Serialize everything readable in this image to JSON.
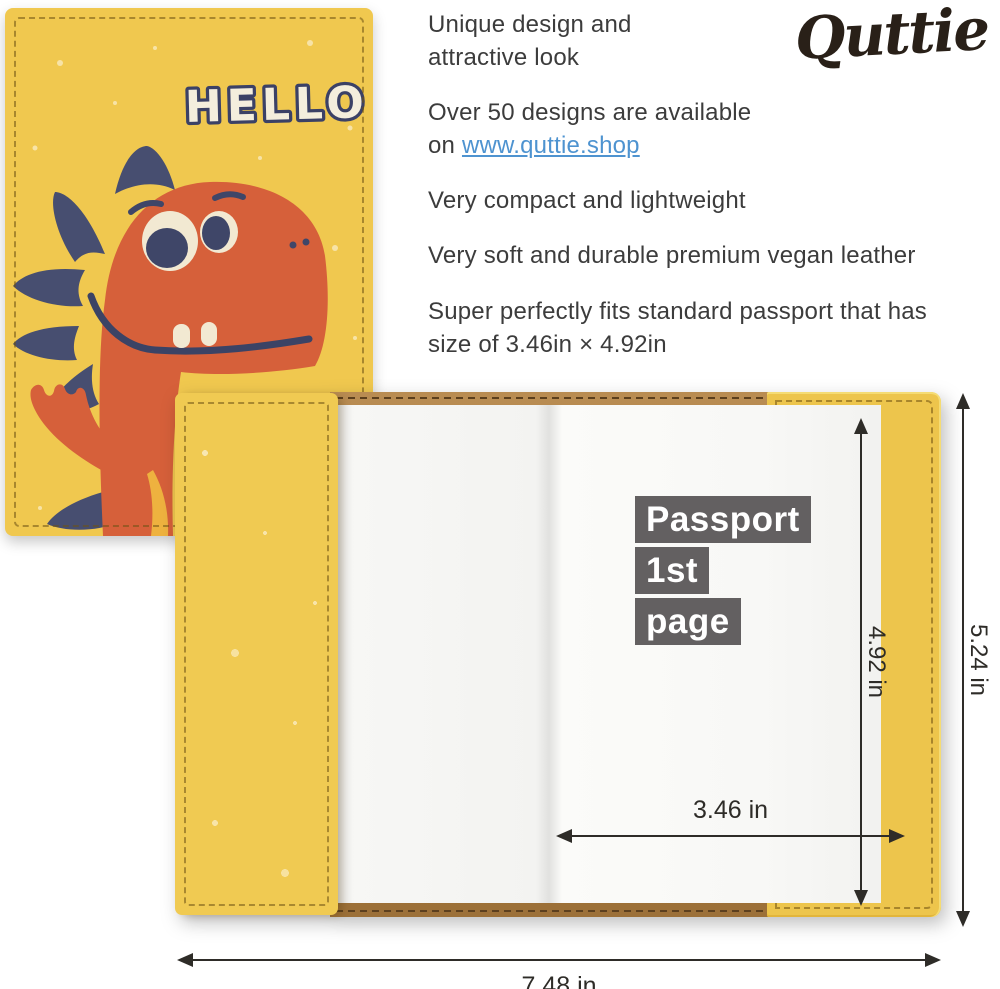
{
  "logo": {
    "text": "Quttie",
    "color": "#292018"
  },
  "front_cover": {
    "hello": "HELLO"
  },
  "features": {
    "items": [
      {
        "text": "Unique design and\nattractive look"
      },
      {
        "text": "Over 50 designs are available\non ",
        "link": "www.quttie.shop"
      },
      {
        "text": "Very compact and lightweight"
      },
      {
        "text": "Very soft and durable premium vegan leather"
      },
      {
        "text": "Super perfectly fits standard passport that has\nsize of 3.46in × 4.92in"
      }
    ]
  },
  "open_passport": {
    "page_label": {
      "line1": "Passport",
      "line2": "1st",
      "line3": "page"
    },
    "tag_text": "www.quttie.shop",
    "dimensions": {
      "page_height": "4.92 in",
      "cover_height": "5.24 in",
      "page_width": "3.46 in",
      "open_width": "7.48 in"
    }
  },
  "colors": {
    "leather_yellow": "#f0c84f",
    "dino_orange": "#d6603a",
    "spike_navy": "#474e70",
    "cream": "#f2e9d2",
    "label_gray": "#636061",
    "link_blue": "#4e93d0",
    "cork_brown": "#ab7d46",
    "arrow_dark": "#2e2c28"
  }
}
